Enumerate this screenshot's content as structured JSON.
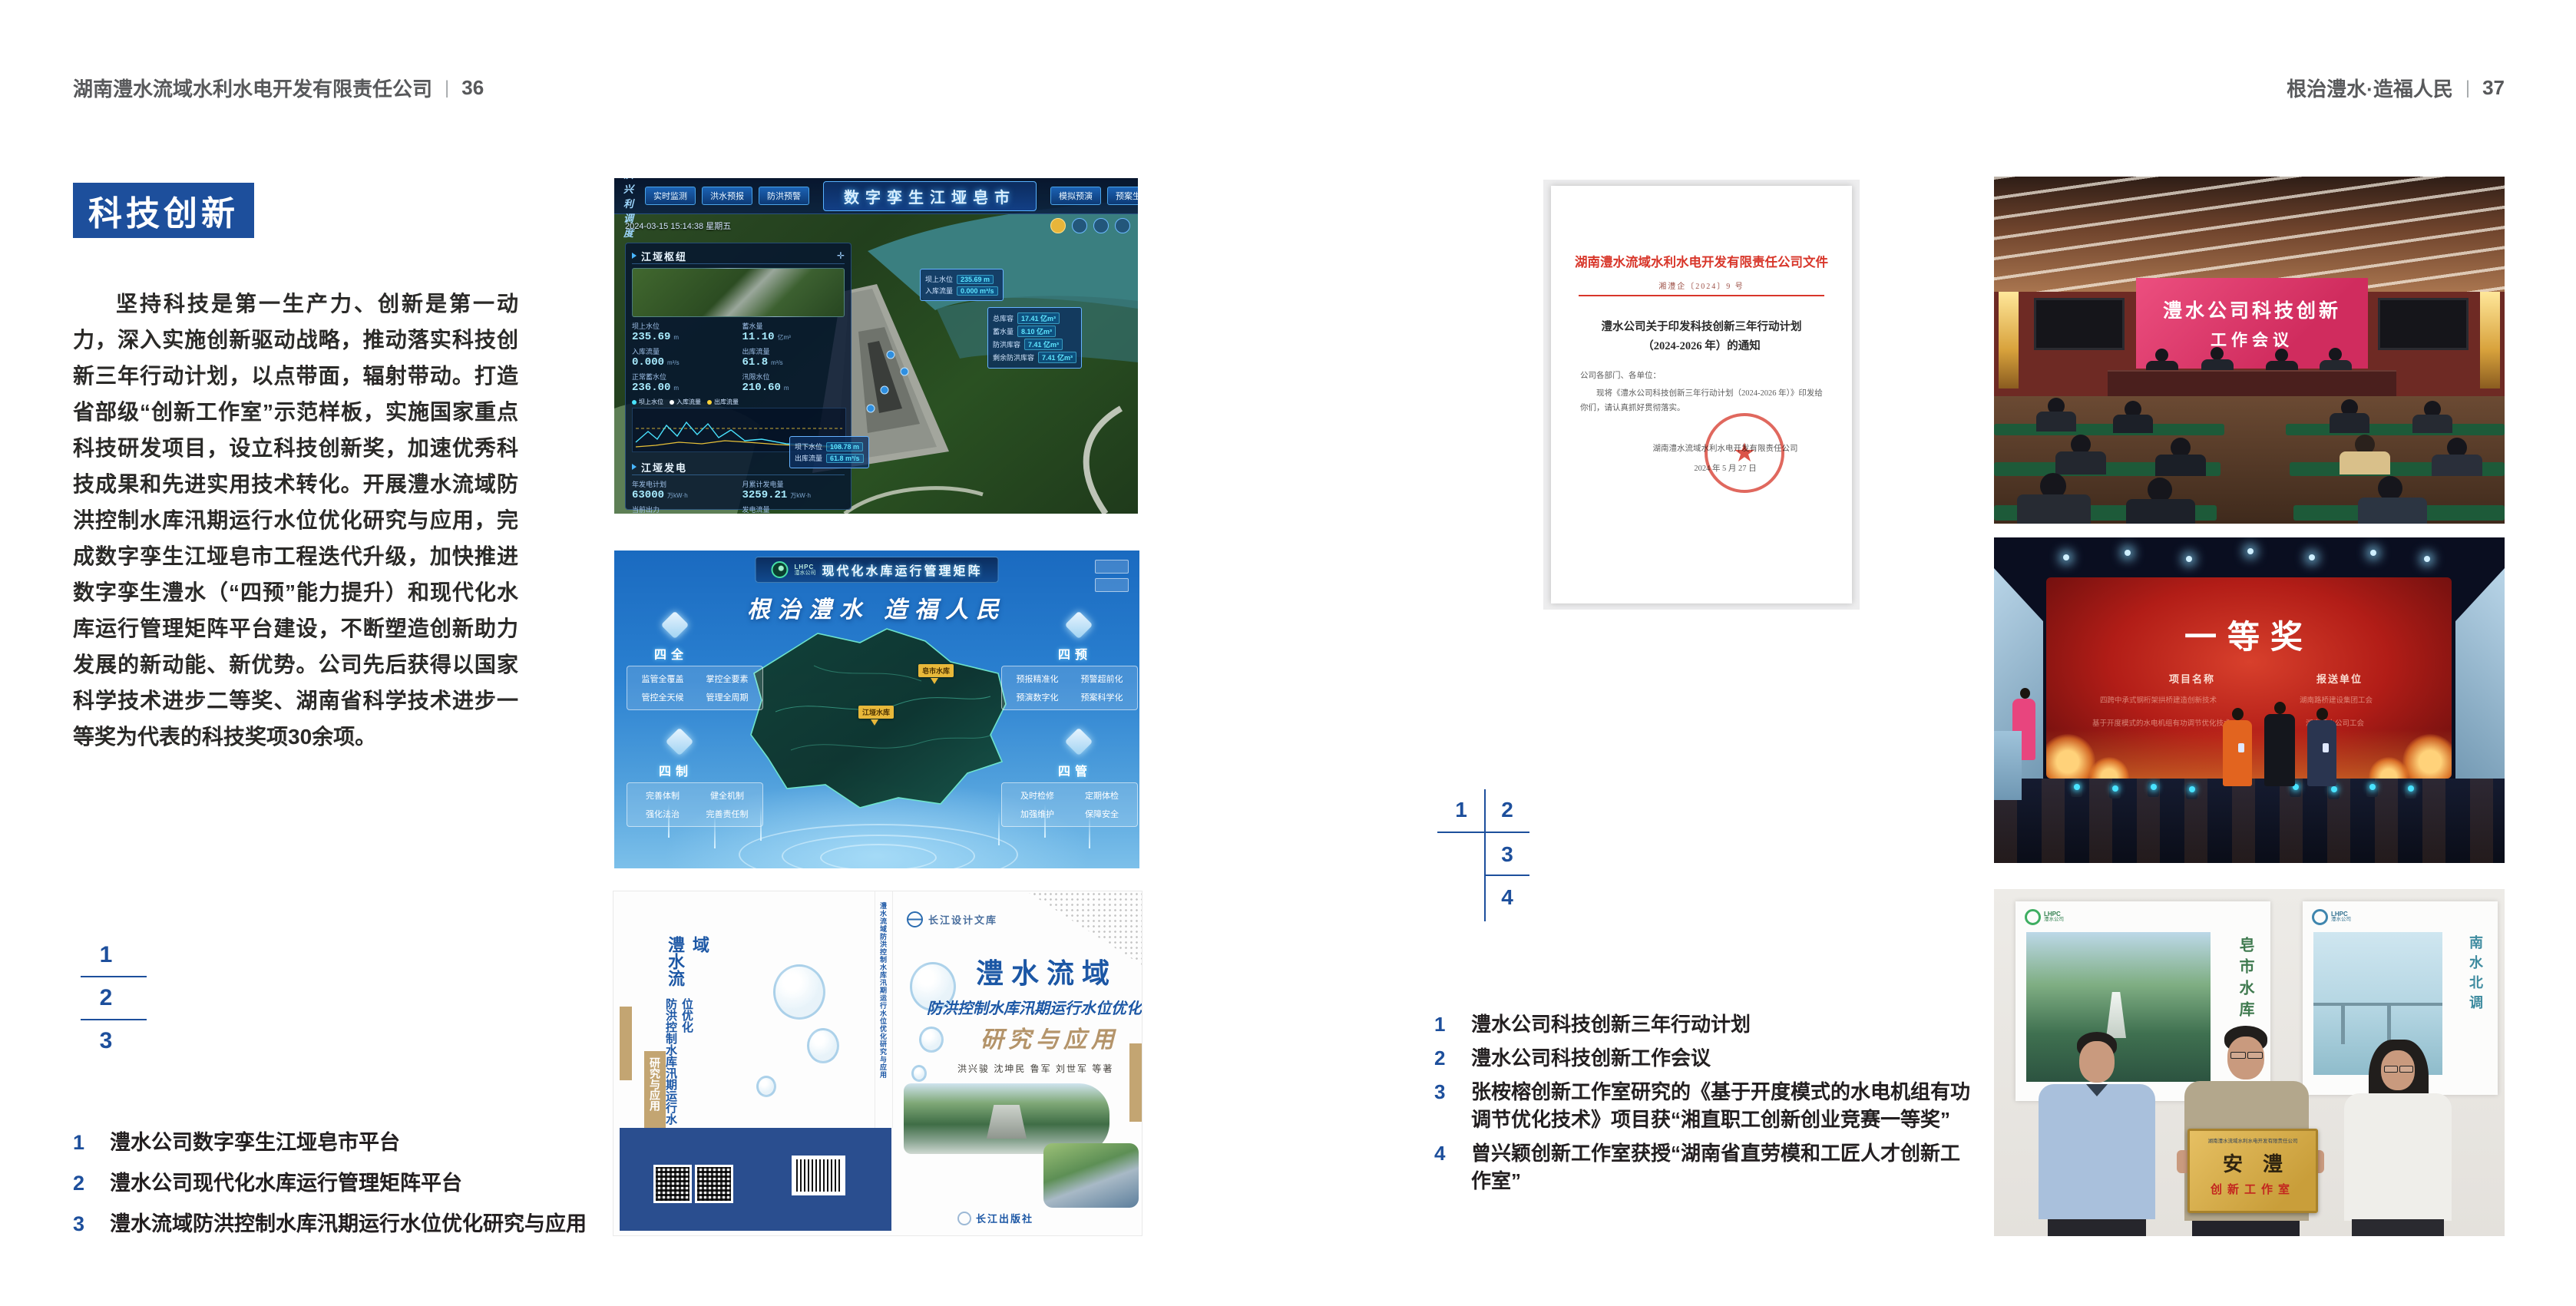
{
  "page_left": {
    "header": {
      "company": "湖南澧水流域水利水电开发有限责任公司",
      "sep": "|",
      "page_no": "36"
    },
    "badge": "科技创新",
    "paragraph": "坚持科技是第一生产力、创新是第一动力，深入实施创新驱动战略，推动落实科技创新三年行动计划，以点带面，辐射带动。打造省部级“创新工作室”示范样板，实施国家重点科技研发项目，设立科技创新奖，加速优秀科技成果和先进实用技术转化。开展澧水流域防洪控制水库汛期运行水位优化研究与应用，完成数字孪生江垭皂市工程迭代升级，加快推进数字孪生澧水（“四预”能力提升）和现代化水库运行管理矩阵平台建设，不断塑造创新助力发展的新动能、新优势。公司先后获得以国家科学技术进步二等奖、湖南省科学技术进步一等奖为代表的科技奖项30余项。",
    "figure_index": [
      "1",
      "2",
      "3"
    ],
    "captions": [
      {
        "num": "1",
        "text": "澧水公司数字孪生江垭皂市平台"
      },
      {
        "num": "2",
        "text": "澧水公司现代化水库运行管理矩阵平台"
      },
      {
        "num": "3",
        "text": "澧水流域防洪控制水库汛期运行水位优化研究与应用"
      }
    ]
  },
  "page_right": {
    "header": {
      "motto": "根治澧水·造福人民",
      "sep": "|",
      "page_no": "37"
    },
    "figure_index": [
      "1",
      "2",
      "3",
      "4"
    ],
    "captions": [
      {
        "num": "1",
        "text": "澧水公司科技创新三年行动计划"
      },
      {
        "num": "2",
        "text": "澧水公司科技创新工作会议"
      },
      {
        "num": "3",
        "text": "张桉榕创新工作室研究的《基于开度模式的水电机组有功调节优化技术》项目获“湘直职工创新创业竞赛一等奖”"
      },
      {
        "num": "4",
        "text": "曾兴颖创新工作室获授“湖南省直劳模和工匠人才创新工作室”"
      }
    ]
  },
  "dashboard": {
    "corner_label": "防洪兴利调度",
    "title": "数字孪生江垭皂市",
    "tabs_left": [
      "实时监测",
      "洪水预报",
      "防洪预警"
    ],
    "tabs_right": [
      "模拟预演",
      "预案生成",
      "调度执行",
      "工程导览"
    ],
    "timestamp": "2024-03-15 15:14:38 星期五",
    "hub_title": "江垭枢纽",
    "hub_stats": [
      {
        "label": "坝上水位",
        "value": "235.69",
        "unit": "m"
      },
      {
        "label": "蓄水量",
        "value": "11.10",
        "unit": "亿m³"
      },
      {
        "label": "入库流量",
        "value": "0.000",
        "unit": "m³/s"
      },
      {
        "label": "出库流量",
        "value": "61.8",
        "unit": "m³/s"
      },
      {
        "label": "正常蓄水位",
        "value": "236.00",
        "unit": "m"
      },
      {
        "label": "汛限水位",
        "value": "210.60",
        "unit": "m"
      }
    ],
    "legend": [
      "坝上水位",
      "入库流量",
      "出库流量"
    ],
    "power_title": "江垭发电",
    "power_stats": [
      {
        "label": "年发电计划",
        "value": "63000",
        "unit": "万kW·h"
      },
      {
        "label": "月累计发电量",
        "value": "3259.21",
        "unit": "万kW·h"
      },
      {
        "label": "当前出力",
        "value": "0.00",
        "unit": "MW"
      },
      {
        "label": "发电流量",
        "value": "0.00",
        "unit": "m³/s"
      }
    ],
    "units": [
      "1#机组",
      "2#机组",
      "3#机组"
    ],
    "box_up": [
      {
        "label": "坝上水位",
        "value": "235.69 m"
      },
      {
        "label": "入库流量",
        "value": "0.000 m³/s"
      }
    ],
    "box_store": [
      {
        "label": "总库容",
        "value": "17.41 亿m³"
      },
      {
        "label": "蓄水量",
        "value": "8.10 亿m³"
      },
      {
        "label": "防洪库容",
        "value": "7.41 亿m³"
      },
      {
        "label": "剩余防洪库容",
        "value": "7.41 亿m³"
      }
    ],
    "box_down": [
      {
        "label": "坝下水位",
        "value": "108.78 m"
      },
      {
        "label": "出库流量",
        "value": "61.8 m³/s"
      }
    ]
  },
  "matrix": {
    "logo_abbr": "LHPC",
    "logo_name": "澧水公司",
    "title": "现代化水库运行管理矩阵",
    "slogan": "根治澧水  造福人民",
    "groups": [
      {
        "name": "四全",
        "items": [
          "监管全覆盖",
          "掌控全要素",
          "管控全天候",
          "管理全周期"
        ]
      },
      {
        "name": "四预",
        "items": [
          "预报精准化",
          "预警超前化",
          "预演数字化",
          "预案科学化"
        ]
      },
      {
        "name": "四制",
        "items": [
          "完善体制",
          "健全机制",
          "强化法治",
          "完善责任制"
        ]
      },
      {
        "name": "四管",
        "items": [
          "及时检修",
          "定期体检",
          "加强维护",
          "保障安全"
        ]
      }
    ],
    "map_labels": [
      "皂市水库",
      "江垭水库"
    ]
  },
  "book": {
    "series": "长江设计文库",
    "title_main": "澧水流域",
    "title_sub": "防洪控制水库汛期运行水位优化",
    "title_tail": "研究与应用",
    "authors": "洪兴骏  沈坤民  鲁军  刘世军  等著",
    "publisher": "长江出版社",
    "spine_title": "澧水流域防洪控制水库汛期运行水位优化研究与应用"
  },
  "doc": {
    "header": "湖南澧水流域水利水电开发有限责任公司文件",
    "doc_no": "湘澧企〔2024〕9 号",
    "title": "澧水公司关于印发科技创新三年行动计划（2024-2026 年）的通知",
    "salutation": "公司各部门、各单位：",
    "body": "现将《澧水公司科技创新三年行动计划（2024-2026 年）》印发给你们，请认真抓好贯彻落实。",
    "signer": "湖南澧水流域水利水电开发有限责任公司",
    "date": "2024 年 5 月 27 日",
    "seal_star": "★"
  },
  "meeting": {
    "screen_line1": "澧水公司科技创新",
    "screen_line2": "工作会议"
  },
  "award": {
    "title": "一等奖",
    "col_project": "项目名称",
    "col_unit": "报送单位",
    "rows": [
      {
        "project": "四跨中承式钢桁架拱桥建造创新技术",
        "unit": "湖南路桥建设集团工会"
      },
      {
        "project": "基于开度模式的水电机组有功调节优化技术",
        "unit": "湖南澧水公司工会"
      }
    ]
  },
  "plaque": {
    "org": "湖南澧水流域水利水电开发有限责任公司",
    "main": "安澧",
    "sub": "创新工作室",
    "poster_left_title": "皂市水库",
    "poster_right_title": "南水北调",
    "logo_abbr": "LHPC",
    "logo_name": "澧水公司"
  }
}
